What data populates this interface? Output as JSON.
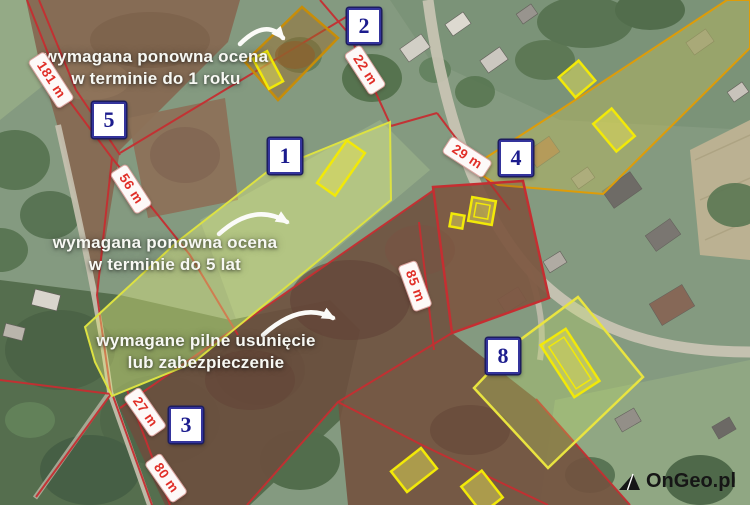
{
  "map": {
    "annotations": [
      {
        "line1": "wymagana ponowna ocena",
        "line2": "w terminie do 1 roku"
      },
      {
        "line1": "wymagana ponowna ocena",
        "line2": "w terminie do 5 lat"
      },
      {
        "line1": "wymagane pilne usunięcie",
        "line2": "lub zabezpieczenie"
      }
    ],
    "parcel_badges": [
      {
        "number": "1"
      },
      {
        "number": "2"
      },
      {
        "number": "3"
      },
      {
        "number": "4"
      },
      {
        "number": "5"
      },
      {
        "number": "8"
      }
    ],
    "measurements": [
      {
        "label": "181 m"
      },
      {
        "label": "56 m"
      },
      {
        "label": "22 m"
      },
      {
        "label": "29 m"
      },
      {
        "label": "85 m"
      },
      {
        "label": "27 m"
      },
      {
        "label": "80 m"
      }
    ],
    "colors": {
      "boundary_red": "#c4282b",
      "highlight_yellow_green": "#dce23c",
      "parcel_orange": "#dd9900",
      "building_yellow": "#f2e900",
      "badge_navy": "#1c1c8e",
      "measure_red": "#e02f28",
      "annotation_white": "#f7f8f3"
    }
  },
  "branding": {
    "logo": "OnGeo.pl"
  }
}
